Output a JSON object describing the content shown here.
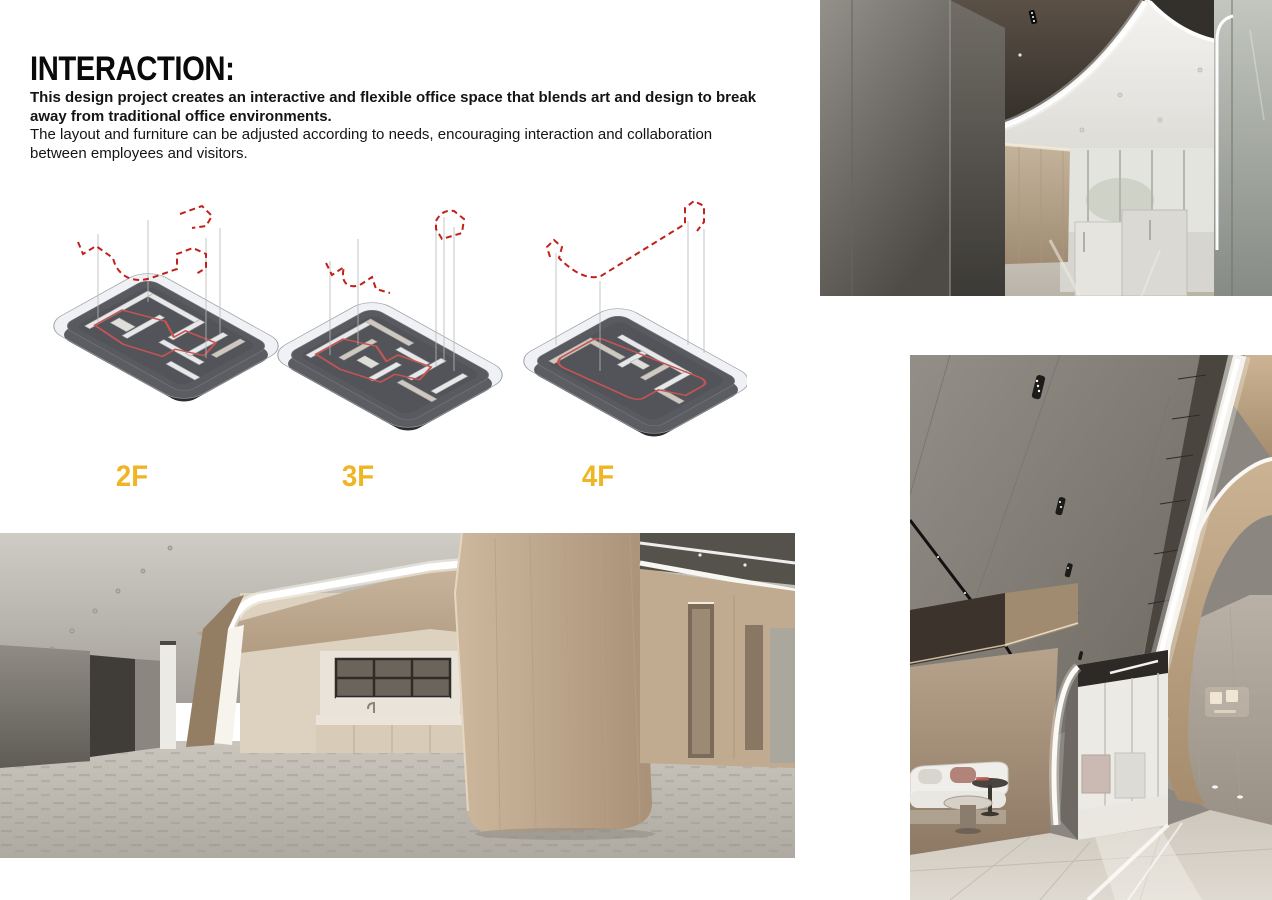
{
  "header": {
    "title": "INTERACTION:",
    "intro_bold_lines": [
      "This design project creates an interactive and flexible office space that blends art and design to break",
      "away from traditional office environments."
    ],
    "intro_regular_lines": [
      "The layout and furniture can be adjusted according to needs, encouraging interaction and collaboration",
      "between employees and visitors."
    ]
  },
  "floors": [
    {
      "label": "2F"
    },
    {
      "label": "3F"
    },
    {
      "label": "4F"
    }
  ],
  "colors": {
    "accent_gold": "#F0B525",
    "diagram_red": "#C2201A",
    "diagram_slab_dark": "#27272A",
    "diagram_wall_white": "#F3F2EF"
  }
}
